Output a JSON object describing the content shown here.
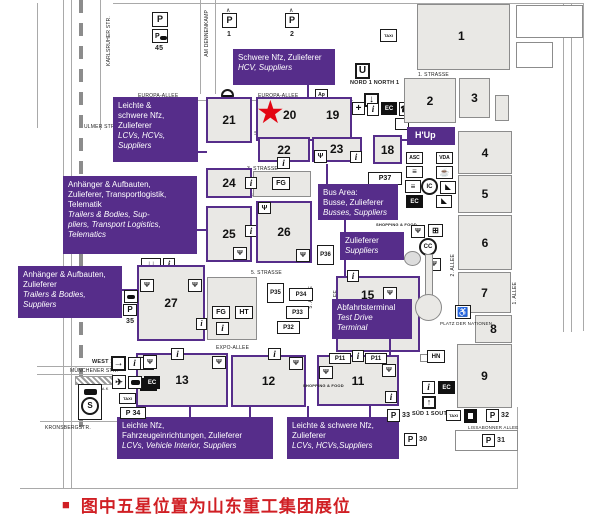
{
  "colors": {
    "purple": "#562d8a",
    "red": "#d01f24",
    "star_red": "#e30613"
  },
  "caption": {
    "bullet": "■",
    "text": "图中五星位置为山东重工集团展位"
  },
  "halls": {
    "h1": "1",
    "h2": "2",
    "h3": "3",
    "h4": "4",
    "h5": "5",
    "h6": "6",
    "h7": "7",
    "h8": "8",
    "h9": "9",
    "h11": "11",
    "h12": "12",
    "h13": "13",
    "h15": "15",
    "h18": "18",
    "h19": "19",
    "h20": "20",
    "h21": "21",
    "h22": "22",
    "h23": "23",
    "h24": "24",
    "h25": "25",
    "h26": "26",
    "h27": "27"
  },
  "labels": {
    "schwere_top": {
      "de": "Schwere Nfz, Zulieferer",
      "en": "HCV, Suppliers"
    },
    "leichte_left": {
      "de": "Leichte &\nschwere Nfz,\nZulieferer",
      "en": "LCVs, HCVs,\nSuppliers"
    },
    "anhaenger_full": {
      "de": "Anhänger & Aufbauten,\nZulieferer, Transportlogistik,\nTelematik",
      "en": "Trailers & Bodies, Sup-\npliers, Transport Logistics,\nTelematics"
    },
    "anhaenger_short": {
      "de": "Anhänger & Aufbauten,\nZulieferer",
      "en": "Trailers & Bodies,\nSuppliers"
    },
    "bus_area": {
      "de": "Bus Area:\nBusse, Zulieferer",
      "en": "Busses, Suppliers"
    },
    "zulieferer": {
      "de": "Zulieferer",
      "en": "Suppliers"
    },
    "hup": "H'Up",
    "abfahrt": {
      "de": "Abfahrtsterminal",
      "en": "Test Drive\nTerminal"
    },
    "leichte_nfz": {
      "de": "Leichte Nfz,\nFahrzeugeinrichtungen, Zulieferer",
      "en": "LCVs, Vehicle Interior, Suppliers"
    },
    "leichte_schwere": {
      "de": "Leichte & schwere Nfz,\nZulieferer",
      "en": "LCVs, HCVs,Suppliers"
    }
  },
  "streets": {
    "europa": "EUROPA-ALLEE",
    "s1": "1. STRASSE",
    "s2": "2. STRASSE",
    "s3": "3. STRASSE",
    "s4": "4. STRASSE",
    "s5": "5. STRASSE",
    "expo": "EXPO-ALLEE",
    "a1": "1. ALLEE",
    "a2": "2. ALLEE",
    "a4": "4. ALLEE",
    "a5": "5. ALLEE",
    "a6": "6. ALLEE",
    "a7": "7. ALLEE",
    "karlsruher": "KARLSRUHER STR.",
    "dennenkamp": "AM DENNENKAMP",
    "ulmer": "ULMER STR.",
    "muenchener": "MÜNCHENER STR.",
    "skywalk": "SKYWALK",
    "kronsberg": "KRONSBERGSTR.",
    "lissabonner": "LISSABONNER ALLEE"
  },
  "entrances": {
    "nord": "NORD 1\nNORTH 1",
    "west": "WEST 1",
    "sued": "SÜD 1\nSOUTH 1"
  },
  "parking": {
    "p": "P",
    "p45": "45",
    "p1": "1",
    "p2": "2",
    "p5": "5",
    "p35": "35",
    "p34": "34",
    "p33": "33",
    "p32": "32",
    "p30": "30",
    "p31": "31",
    "pp11": "P11",
    "pp35": "P35",
    "pp34": "P34",
    "pp33": "P33",
    "pp32": "P32",
    "pp36": "P36",
    "pp37": "P37"
  },
  "badges": {
    "taxi": "TAXI",
    "fg": "FG",
    "ht": "HT",
    "hn": "HN",
    "asc": "ASC",
    "vda": "VDA",
    "ec": "EC",
    "ic": "IC",
    "cc": "CC",
    "u": "U",
    "s": "S",
    "i": "i",
    "ap": "Ap",
    "plus": "+"
  },
  "misc": {
    "shopping_food": "SHOPPING\n& FOOD",
    "platz": "PLATZ DER\nNATIONEN"
  },
  "icons": {
    "star": "★",
    "restaurant": "Ψ",
    "phone": "☎",
    "down": "↓",
    "downdown": "↓↓",
    "up": "↑",
    "right": "→",
    "plane": "✈",
    "coffee": "☕",
    "wheelchair": "♿",
    "lines": "≡",
    "grid": "⊞",
    "corner": "◣",
    "roof": "∧"
  }
}
